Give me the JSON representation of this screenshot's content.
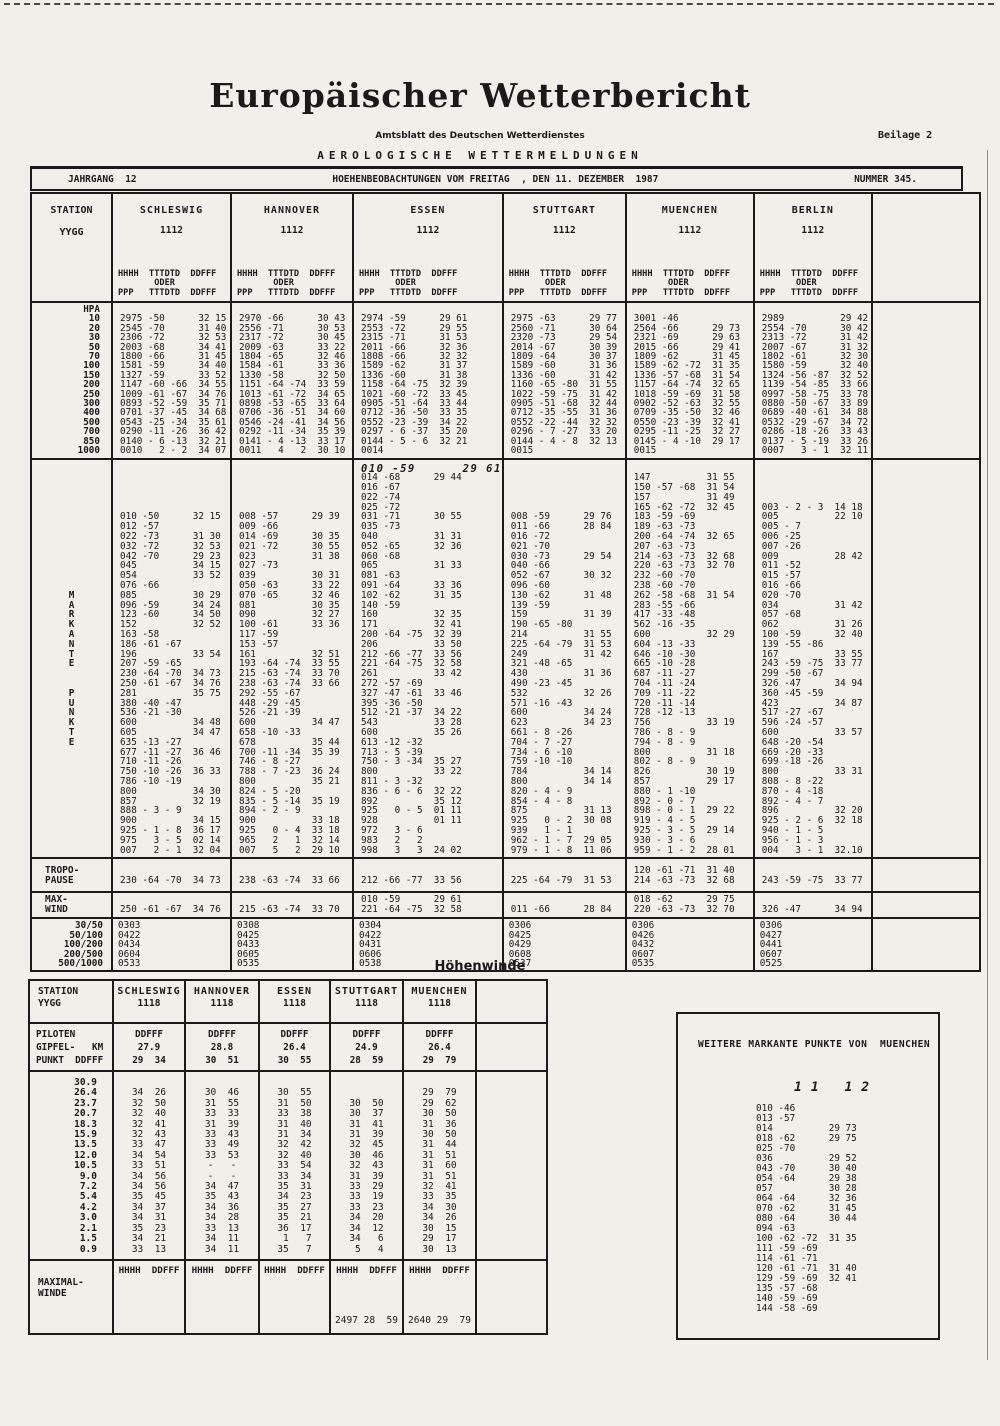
{
  "header": {
    "title": "Europäischer Wetterbericht",
    "subtitle": "Amtsblatt des Deutschen Wetterdienstes",
    "beilage": "Beilage 2",
    "section": "AEROLOGISCHE WETTERMELDUNGEN",
    "jahrgang": "JAHRGANG  12",
    "issue_line": "HOEHENBEOBACHTUNGEN VOM FREITAG  , DEN 11. DEZEMBER  1987",
    "nummer": "NUMMER 345."
  },
  "main_table": {
    "corner": {
      "station": "STATION",
      "yygg": "YYGG"
    },
    "col_head": [
      "HHHH  TTTDTD  DDFFF",
      "       ODER",
      "PPP   TTTDTD  DDFFF"
    ],
    "hpa": "HPA",
    "levels": [
      "10",
      "20",
      "30",
      "50",
      "70",
      "100",
      "150",
      "200",
      "250",
      "300",
      "400",
      "500",
      "700",
      "850",
      "1000"
    ],
    "tropo_label": [
      "TROPO-",
      "PAUSE"
    ],
    "maxwind_label": [
      "MAX-",
      "WIND"
    ],
    "thickness_labels": [
      "30/50",
      "50/100",
      "100/200",
      "200/500",
      "500/1000"
    ],
    "gutter": [
      "",
      "",
      "",
      "",
      "",
      "",
      "",
      "",
      "",
      "",
      "",
      "",
      "",
      "M",
      "A",
      "R",
      "K",
      "A",
      "N",
      "T",
      "E",
      "",
      "",
      "P",
      "U",
      "N",
      "K",
      "T",
      "E",
      "",
      "",
      "",
      "",
      "",
      "",
      "",
      "",
      "",
      "",
      ""
    ],
    "stations": [
      {
        "name": "SCHLESWIG",
        "time": "1112",
        "pressure": [
          "2975 -50      32 15",
          "2545 -70      31 40",
          "2306 -72      32 53",
          "2003 -68      34 41",
          "1800 -66      31 45",
          "1581 -59      34 40",
          "1327 -59      33 52",
          "1147 -60 -66  34 55",
          "1009 -61 -67  34 76",
          "0893 -52 -59  35 71",
          "0701 -37 -45  34 68",
          "0543 -25 -34  35 61",
          "0290 -11 -26  36 42",
          "0140 - 6 -13  32 21",
          "0010   2 - 2  34 07"
        ],
        "sig": [
          "",
          "",
          "",
          "",
          "",
          "010 -50      32 15",
          "012 -57",
          "022 -73      31 30",
          "032 -72      32 53",
          "042 -70      29 23",
          "045          34 15",
          "054          33 52",
          "076 -66",
          "085          30 29",
          "096 -59      34 24",
          "123 -60      34 50",
          "152          32 52",
          "163 -58",
          "186 -61 -67",
          "196          33 54",
          "207 -59 -65",
          "230 -64 -70  34 73",
          "250 -61 -67  34 76",
          "281          35 75",
          "380 -40 -47",
          "536 -21 -30",
          "600          34 48",
          "605          34 47",
          "635 -13 -27",
          "677 -11 -27  36 46",
          "710 -11 -26",
          "750 -10 -26  36 33",
          "786 -10 -19",
          "800          34 30",
          "857          32 19",
          "888 - 3 - 9",
          "900          34 15",
          "925 - 1 - 8  36 17",
          "975   3 - 5  02 14",
          "007   2 - 1  32 04"
        ],
        "tropo": [
          "",
          "230 -64 -70  34 73"
        ],
        "maxwind": [
          "",
          "250 -61 -67  34 76"
        ],
        "thickness": [
          "0303",
          "0422",
          "0434",
          "0604",
          "0533"
        ]
      },
      {
        "name": "HANNOVER",
        "time": "1112",
        "pressure": [
          "2970 -66      30 43",
          "2556 -71      30 53",
          "2317 -72      30 45",
          "2009 -63      33 22",
          "1804 -65      32 46",
          "1584 -61      33 36",
          "1330 -58      32 50",
          "1151 -64 -74  33 59",
          "1013 -61 -72  34 65",
          "0898 -53 -65  33 64",
          "0706 -36 -51  34 60",
          "0546 -24 -41  34 56",
          "0292 -11 -34  35 39",
          "0141 - 4 -13  33 17",
          "0011   4   2  30 10"
        ],
        "sig": [
          "",
          "",
          "",
          "",
          "",
          "008 -57      29 39",
          "009 -66",
          "014 -69      30 35",
          "021 -72      30 55",
          "023          31 38",
          "027 -73",
          "039          30 31",
          "050 -63      33 22",
          "070 -65      32 46",
          "081          30 35",
          "090          32 27",
          "100 -61      33 36",
          "117 -59",
          "153 -57",
          "161          32 51",
          "193 -64 -74  33 55",
          "215 -63 -74  33 70",
          "238 -63 -74  33 66",
          "292 -55 -67",
          "448 -29 -45",
          "526 -21 -39",
          "600          34 47",
          "658 -10 -33",
          "678          35 44",
          "700 -11 -34  35 39",
          "746 - 8 -27",
          "788 - 7 -23  36 24",
          "800          35 21",
          "824 - 5 -20",
          "835 - 5 -14  35 19",
          "894 - 2 - 9",
          "900          33 18",
          "925   0 - 4  33 18",
          "965   2   1  32 14",
          "007   5   2  29 10"
        ],
        "tropo": [
          "",
          "238 -63 -74  33 66"
        ],
        "maxwind": [
          "",
          "215 -63 -74  33 70"
        ],
        "thickness": [
          "0308",
          "0425",
          "0433",
          "0605",
          "0535"
        ]
      },
      {
        "name": "ESSEN",
        "time": "1112",
        "sig_hand": 0,
        "pressure": [
          "2974 -59      29 61",
          "2553 -72      29 55",
          "2315 -71      31 53",
          "2011 -66      32 36",
          "1808 -66      32 32",
          "1589 -62      31 37",
          "1336 -60      31 38",
          "1158 -64 -75  32 39",
          "1021 -60 -72  33 45",
          "0905 -51 -64  33 44",
          "0712 -36 -50  33 35",
          "0552 -23 -39  34 22",
          "0297 - 6 -37  35 20",
          "0144 - 5 - 6  32 21",
          "0014"
        ],
        "sig": [
          "010 -59      29 61",
          "014 -68      29 44",
          "016 -67",
          "022 -74",
          "025 -72",
          "031 -71      30 55",
          "035 -73",
          "040          31 31",
          "052 -65      32 36",
          "060 -68",
          "065          31 33",
          "081 -63",
          "091 -64      33 36",
          "102 -62      31 35",
          "140 -59",
          "160          32 35",
          "171          32 41",
          "200 -64 -75  32 39",
          "206          33 50",
          "212 -66 -77  33 56",
          "221 -64 -75  32 58",
          "261          33 42",
          "272 -57 -69",
          "327 -47 -61  33 46",
          "395 -36 -50",
          "512 -21 -37  34 22",
          "543          33 28",
          "600          35 26",
          "613 -12 -32",
          "713 - 5 -39",
          "750 - 3 -34  35 27",
          "800          33 22",
          "811 - 3 -32",
          "836 - 6 - 6  32 22",
          "892          35 12",
          "925   0 - 5  01 11",
          "928          01 11",
          "972   3 - 6",
          "983   2   2",
          "998   3   3  24 02"
        ],
        "tropo": [
          "",
          "212 -66 -77  33 56"
        ],
        "maxwind": [
          "010 -59      29 61",
          "221 -64 -75  32 58"
        ],
        "thickness": [
          "0304",
          "0422",
          "0431",
          "0606",
          "0538"
        ]
      },
      {
        "name": "STUTTGART",
        "time": "1112",
        "pressure": [
          "2975 -63      29 77",
          "2560 -71      30 64",
          "2320 -73      29 54",
          "2014 -67      30 39",
          "1809 -64      30 37",
          "1589 -60      31 36",
          "1336 -60      31 42",
          "1160 -65 -80  31 55",
          "1022 -59 -75  31 42",
          "0905 -51 -68  32 44",
          "0712 -35 -55  31 36",
          "0552 -22 -44  32 32",
          "0296 - 7 -27  33 20",
          "0144 - 4 - 8  32 13",
          "0015"
        ],
        "sig": [
          "",
          "",
          "",
          "",
          "",
          "008 -59      29 76",
          "011 -66      28 84",
          "016 -72",
          "021 -70",
          "030 -73      29 54",
          "040 -66",
          "052 -67      30 32",
          "096 -60",
          "130 -62      31 48",
          "139 -59",
          "159          31 39",
          "190 -65 -80",
          "214          31 55",
          "225 -64 -79  31 53",
          "249          31 42",
          "321 -48 -65",
          "430          31 36",
          "490 -23 -45",
          "532          32 26",
          "571 -16 -43",
          "600          34 24",
          "623          34 23",
          "661 - 8 -26",
          "704 - 7 -27",
          "734 - 6 -10",
          "759 -10 -10",
          "784          34 14",
          "800          34 14",
          "820 - 4 - 9",
          "854 - 4 - 8",
          "875          31 13",
          "925   0 - 2  30 08",
          "939   1 - 1",
          "962 - 1 - 7  29 05",
          "979 - 1 - 8  11 06"
        ],
        "tropo": [
          "",
          "225 -64 -79  31 53"
        ],
        "maxwind": [
          "",
          "011 -66      28 84"
        ],
        "thickness": [
          "0306",
          "0425",
          "0429",
          "0608",
          "0537"
        ]
      },
      {
        "name": "MUENCHEN",
        "time": "1112",
        "pressure": [
          "3001 -46",
          "2564 -66      29 73",
          "2321 -69      29 63",
          "2015 -66      29 41",
          "1809 -62      31 45",
          "1589 -62 -72  31 35",
          "1336 -57 -68  31 54",
          "1157 -64 -74  32 65",
          "1018 -59 -69  31 58",
          "0902 -52 -63  32 55",
          "0709 -35 -50  32 46",
          "0550 -23 -39  32 41",
          "0295 -11 -25  32 27",
          "0145 - 4 -10  29 17",
          "0015"
        ],
        "sig": [
          "",
          "147          31 55",
          "150 -57 -68  31 54",
          "157          31 49",
          "165 -62 -72  32 45",
          "183 -59 -69",
          "189 -63 -73",
          "200 -64 -74  32 65",
          "207 -63 -73",
          "214 -63 -73  32 68",
          "220 -63 -73  32 70",
          "232 -60 -70",
          "238 -60 -70",
          "262 -58 -68  31 54",
          "283 -55 -66",
          "417 -33 -48",
          "562 -16 -35",
          "600          32 29",
          "604 -13 -33",
          "646 -10 -30",
          "665 -10 -28",
          "687 -11 -27",
          "704 -11 -24",
          "709 -11 -22",
          "720 -11 -14",
          "728 -12 -13",
          "756          33 19",
          "786 - 8 - 9",
          "794 - 8 - 9",
          "800          31 18",
          "802 - 8 - 9",
          "826          30 19",
          "857          29 17",
          "880 - 1 -10",
          "892 - 0 - 7",
          "898 - 0 - 1  29 22",
          "919 - 4 - 5",
          "925 - 3 - 5  29 14",
          "930 - 3 - 6",
          "959 - 1 - 2  28 01"
        ],
        "tropo": [
          "120 -61 -71  31 40",
          "214 -63 -73  32 68"
        ],
        "maxwind": [
          "018 -62      29 75",
          "220 -63 -73  32 70"
        ],
        "thickness": [
          "0306",
          "0426",
          "0432",
          "0607",
          "0535"
        ]
      },
      {
        "name": "BERLIN",
        "time": "1112",
        "pressure": [
          "2989          29 42",
          "2554 -70      30 42",
          "2313 -72      31 42",
          "2007 -67      31 32",
          "1802 -61      32 30",
          "1580 -59      32 40",
          "1324 -56 -87  32 52",
          "1139 -54 -85  33 66",
          "0997 -58 -75  33 78",
          "0880 -50 -67  33 89",
          "0689 -40 -61  34 88",
          "0532 -29 -67  34 72",
          "0286 -18 -26  33 43",
          "0137 - 5 -19  33 26",
          "0007   3 - 1  32 11"
        ],
        "sig": [
          "",
          "",
          "",
          "",
          "003 - 2 - 3  14 18",
          "005          22 10",
          "005 - 7",
          "006 -25",
          "007 -26",
          "009          28 42",
          "011 -52",
          "015 -57",
          "016 -66",
          "020 -70",
          "034          31 42",
          "057 -68",
          "062          31 26",
          "100 -59      32 40",
          "139 -55 -86",
          "167          33 55",
          "243 -59 -75  33 77",
          "299 -50 -67",
          "326 -47      34 94",
          "360 -45 -59",
          "423          34 87",
          "517 -27 -67",
          "596 -24 -57",
          "600          33 57",
          "648 -20 -54",
          "669 -20 -33",
          "699 -18 -26",
          "800          33 31",
          "808 - 8 -22",
          "870 - 4 -18",
          "892 - 4 - 7",
          "896          32 20",
          "925 - 2 - 6  32 18",
          "940 - 1 - 5",
          "956 - 1 - 3",
          "004   3 - 1  32.10"
        ],
        "tropo": [
          "",
          "243 -59 -75  33 77"
        ],
        "maxwind": [
          "",
          "326 -47      34 94"
        ],
        "thickness": [
          "0306",
          "0427",
          "0441",
          "0607",
          "0525"
        ]
      }
    ]
  },
  "hoehenwinde": {
    "title": "Höhenwinde",
    "corner": [
      "STATION",
      "YYGG"
    ],
    "pilot_label": [
      "PILOTEN",
      "GIPFEL-   KM",
      "PUNKT  DDFFF"
    ],
    "ddfff": "DDFFF",
    "altitudes": [
      "30.9",
      "26.4",
      "23.7",
      "20.7",
      "18.3",
      "15.9",
      "13.5",
      "12.0",
      "10.5",
      "9.0",
      "7.2",
      "5.4",
      "4.2",
      "3.0",
      "2.1",
      "1.5",
      "0.9"
    ],
    "maximal_label": [
      "MAXIMAL-",
      "WINDE"
    ],
    "max_head": "HHHH  DDFFF",
    "stations": [
      {
        "name": "SCHLESWIG",
        "time": "1118",
        "gipfel_km": "27.9",
        "gipfel_wind": "29  34",
        "max": "",
        "winds": [
          "",
          "34  26",
          "32  50",
          "32  40",
          "32  41",
          "32  43",
          "33  47",
          "34  54",
          "33  51",
          "34  56",
          "34  56",
          "35  45",
          "34  37",
          "34  31",
          "35  23",
          "34  21",
          "33  13"
        ]
      },
      {
        "name": "HANNOVER",
        "time": "1118",
        "gipfel_km": "28.8",
        "gipfel_wind": "30  51",
        "max": "",
        "winds": [
          "",
          "30  46",
          "31  55",
          "33  33",
          "31  39",
          "33  43",
          "33  49",
          "33  53",
          "-   -",
          "-   -",
          "34  47",
          "35  43",
          "34  36",
          "34  28",
          "33  13",
          "34  11",
          "34  11"
        ]
      },
      {
        "name": "ESSEN",
        "time": "1118",
        "gipfel_km": "26.4",
        "gipfel_wind": "30  55",
        "max": "",
        "winds": [
          "",
          "30  55",
          "31  50",
          "33  38",
          "31  40",
          "31  34",
          "32  42",
          "32  40",
          "33  54",
          "33  34",
          "35  31",
          "34  23",
          "35  27",
          "35  21",
          "36  17",
          " 1   7",
          "35   7"
        ]
      },
      {
        "name": "STUTTGART",
        "time": "1118",
        "gipfel_km": "24.9",
        "gipfel_wind": "28  59",
        "max": "2497 28  59",
        "winds": [
          "",
          "",
          "30  50",
          "30  37",
          "31  41",
          "31  39",
          "32  45",
          "30  46",
          "32  43",
          "31  39",
          "33  29",
          "33  19",
          "33  23",
          "34  20",
          "34  12",
          "34   6",
          " 5   4"
        ]
      },
      {
        "name": "MUENCHEN",
        "time": "1118",
        "gipfel_km": "26.4",
        "gipfel_wind": "29  79",
        "max": "2640 29  79",
        "winds": [
          "",
          "29  79",
          "29  62",
          "30  50",
          "31  36",
          "30  50",
          "31  44",
          "31  51",
          "31  60",
          "31  51",
          "32  41",
          "33  35",
          "34  30",
          "34  26",
          "30  15",
          "29  17",
          "30  13"
        ]
      }
    ]
  },
  "weitere": {
    "title": "WEITERE MARKANTE PUNKTE VON  MUENCHEN",
    "handwritten": "11  12",
    "lines": [
      "010 -46",
      "013 -57",
      "014          29 73",
      "018 -62      29 75",
      "025 -70",
      "036          29 52",
      "043 -70      30 40",
      "054 -64      29 38",
      "057          30 28",
      "064 -64      32 36",
      "070 -62      31 45",
      "080 -64      30 44",
      "094 -63",
      "100 -62 -72  31 35",
      "111 -59 -69",
      "114 -61 -71",
      "120 -61 -71  31 40",
      "129 -59 -69  32 41",
      "135 -57 -68",
      "140 -59 -69",
      "144 -58 -69"
    ]
  }
}
